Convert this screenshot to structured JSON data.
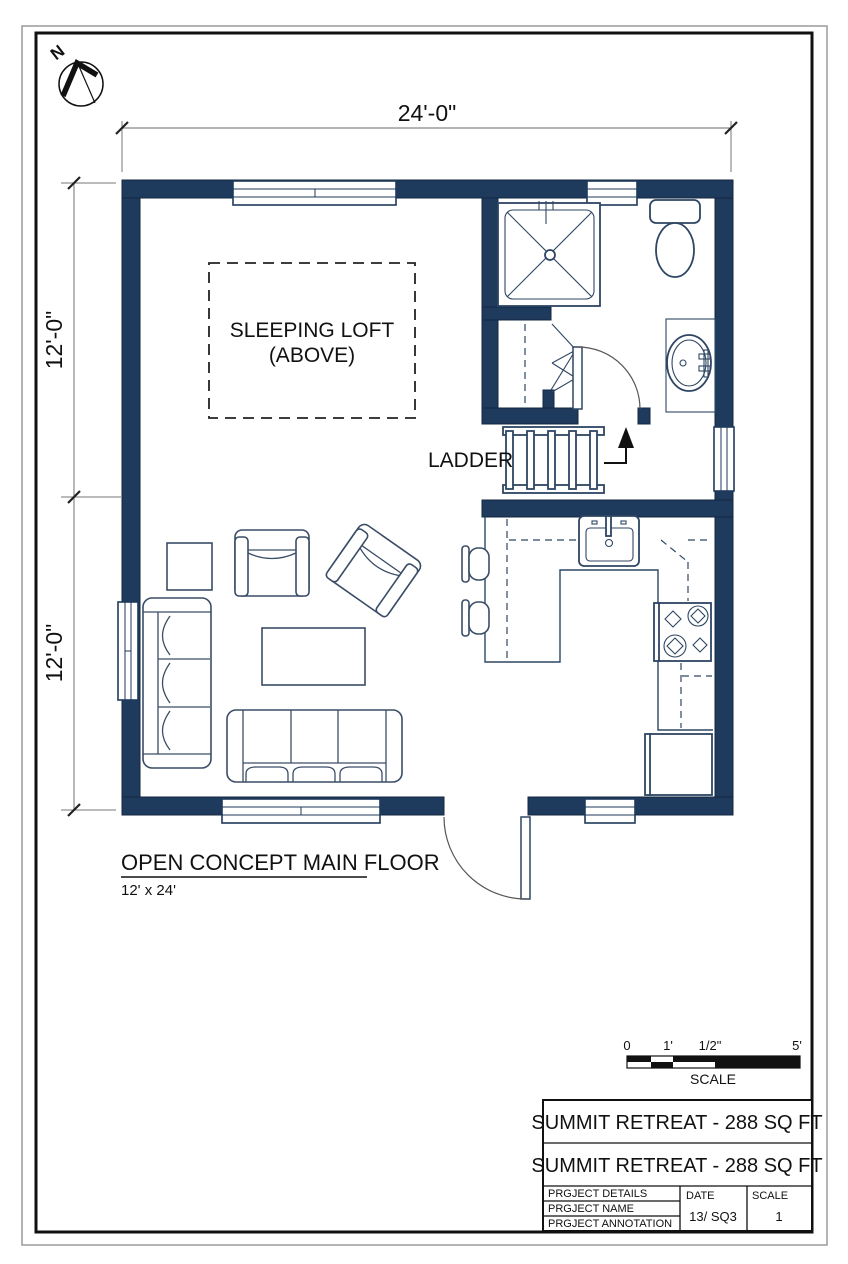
{
  "colors": {
    "wall": "#1e3a5c",
    "line": "#2e4663",
    "text": "#111111"
  },
  "compass": {
    "label": "N"
  },
  "dimensions": {
    "top": "24'-0\"",
    "left_upper": "12'-0\"",
    "left_lower": "12'-0\""
  },
  "loft": {
    "line1": "SLEEPING LOFT",
    "line2": "(ABOVE)"
  },
  "ladder": {
    "label": "LADDER"
  },
  "floor_label": {
    "title": "OPEN CONCEPT MAIN FLOOR",
    "size": "12' x 24'"
  },
  "scale_bar": {
    "tick0": "0",
    "tick1": "1'",
    "tick2": "1/2\"",
    "tick3": "5'",
    "label": "SCALE"
  },
  "title_block": {
    "title_row1": "SUMMIT RETREAT - 288 SQ FT",
    "title_row2": "SUMMIT RETREAT - 288 SQ FT",
    "row1": "PRGJECT DETAILS",
    "row2": "PRGJECT NAME",
    "row3": "PRGJECT ANNOTATION",
    "date_label": "DATE",
    "date_value": "13/ SQ3",
    "scale_label": "SCALE",
    "scale_value": "1"
  }
}
